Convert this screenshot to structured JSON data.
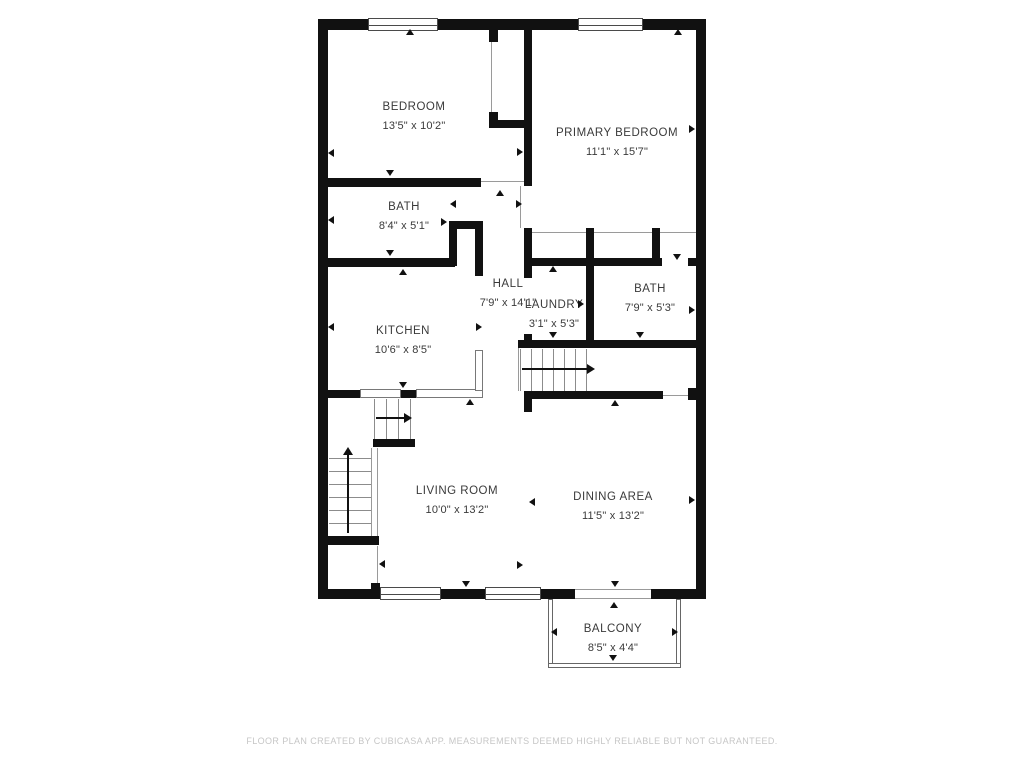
{
  "floorplan": {
    "colors": {
      "wall": "#111111",
      "label": "#3a3a3a",
      "thin_line": "#9a9a9a",
      "footer": "#c6c6c6",
      "background": "#ffffff"
    },
    "rooms": [
      {
        "id": "bedroom",
        "name": "BEDROOM",
        "dims": "13'5\" x 10'2\"",
        "cx": 414,
        "cy": 107
      },
      {
        "id": "primary-bedroom",
        "name": "PRIMARY BEDROOM",
        "dims": "11'1\" x 15'7\"",
        "cx": 617,
        "cy": 133
      },
      {
        "id": "bath",
        "name": "BATH",
        "dims": "8'4\" x 5'1\"",
        "cx": 404,
        "cy": 207
      },
      {
        "id": "hall",
        "name": "HALL",
        "dims": "7'9\" x 14'1\"",
        "cx": 508,
        "cy": 284
      },
      {
        "id": "laundry",
        "name": "LAUNDRY",
        "dims": "3'1\" x 5'3\"",
        "cx": 554,
        "cy": 305
      },
      {
        "id": "bath-2",
        "name": "BATH",
        "dims": "7'9\" x 5'3\"",
        "cx": 650,
        "cy": 289
      },
      {
        "id": "kitchen",
        "name": "KITCHEN",
        "dims": "10'6\" x 8'5\"",
        "cx": 403,
        "cy": 331
      },
      {
        "id": "living-room",
        "name": "LIVING ROOM",
        "dims": "10'0\" x 13'2\"",
        "cx": 457,
        "cy": 491
      },
      {
        "id": "dining-area",
        "name": "DINING AREA",
        "dims": "11'5\" x 13'2\"",
        "cx": 613,
        "cy": 497
      },
      {
        "id": "balcony",
        "name": "BALCONY",
        "dims": "8'5\" x 4'4\"",
        "cx": 613,
        "cy": 629
      }
    ],
    "walls": [
      [
        318,
        19,
        388,
        11
      ],
      [
        318,
        19,
        10,
        580
      ],
      [
        696,
        19,
        10,
        580
      ],
      [
        318,
        589,
        62,
        10
      ],
      [
        441,
        589,
        44,
        10
      ],
      [
        541,
        589,
        34,
        10
      ],
      [
        651,
        589,
        55,
        10
      ],
      [
        318,
        178,
        163,
        9
      ],
      [
        524,
        28,
        8,
        158
      ],
      [
        489,
        28,
        9,
        14
      ],
      [
        489,
        112,
        9,
        16
      ],
      [
        489,
        120,
        43,
        8
      ],
      [
        318,
        258,
        137,
        9
      ],
      [
        449,
        221,
        8,
        45
      ],
      [
        449,
        221,
        34,
        8
      ],
      [
        475,
        221,
        8,
        55
      ],
      [
        524,
        228,
        8,
        38
      ],
      [
        586,
        228,
        8,
        118
      ],
      [
        652,
        228,
        8,
        38
      ],
      [
        524,
        258,
        138,
        8
      ],
      [
        688,
        258,
        8,
        8
      ],
      [
        524,
        266,
        8,
        12
      ],
      [
        524,
        334,
        8,
        12
      ],
      [
        518,
        340,
        188,
        8
      ],
      [
        528,
        391,
        135,
        8
      ],
      [
        524,
        391,
        8,
        21
      ],
      [
        688,
        388,
        8,
        12
      ],
      [
        318,
        390,
        42,
        8
      ],
      [
        401,
        390,
        15,
        8
      ],
      [
        373,
        439,
        42,
        8
      ],
      [
        326,
        536,
        53,
        9
      ],
      [
        371,
        583,
        9,
        7
      ]
    ],
    "thin_lines": [
      [
        491,
        42,
        1,
        71
      ],
      [
        520,
        186,
        1,
        42
      ],
      [
        532,
        232,
        54,
        1
      ],
      [
        594,
        232,
        58,
        1
      ],
      [
        660,
        232,
        36,
        1
      ],
      [
        481,
        181,
        43,
        1
      ],
      [
        663,
        395,
        25,
        1
      ],
      [
        518,
        348,
        1,
        43
      ],
      [
        371,
        448,
        1,
        89
      ],
      [
        377,
        448,
        1,
        89
      ],
      [
        377,
        546,
        1,
        43
      ]
    ],
    "stair_treads": [
      [
        520,
        349,
        1,
        42
      ],
      [
        531,
        349,
        1,
        42
      ],
      [
        542,
        349,
        1,
        42
      ],
      [
        553,
        349,
        1,
        42
      ],
      [
        564,
        349,
        1,
        42
      ],
      [
        575,
        349,
        1,
        42
      ],
      [
        586,
        349,
        1,
        42
      ],
      [
        374,
        399,
        1,
        40
      ],
      [
        386,
        399,
        1,
        40
      ],
      [
        398,
        399,
        1,
        40
      ],
      [
        410,
        399,
        1,
        40
      ],
      [
        329,
        458,
        42,
        1
      ],
      [
        329,
        471,
        42,
        1
      ],
      [
        329,
        484,
        42,
        1
      ],
      [
        329,
        497,
        42,
        1
      ],
      [
        329,
        510,
        42,
        1
      ],
      [
        329,
        523,
        42,
        1
      ]
    ],
    "windows": [
      [
        368,
        18,
        70,
        13
      ],
      [
        578,
        18,
        65,
        13
      ],
      [
        380,
        587,
        61,
        13
      ],
      [
        485,
        587,
        56,
        13
      ]
    ],
    "counters": [
      [
        360,
        389,
        41,
        9
      ],
      [
        416,
        389,
        67,
        9
      ],
      [
        475,
        350,
        8,
        41
      ]
    ],
    "openings": [
      [
        575,
        589,
        76,
        10
      ]
    ],
    "railings": [
      [
        548,
        599,
        5,
        66
      ],
      [
        676,
        599,
        5,
        66
      ],
      [
        548,
        663,
        133,
        5
      ]
    ],
    "markers": [
      [
        328,
        153,
        "left"
      ],
      [
        410,
        29,
        "up"
      ],
      [
        390,
        176,
        "down"
      ],
      [
        500,
        190,
        "up"
      ],
      [
        523,
        152,
        "right"
      ],
      [
        695,
        129,
        "right"
      ],
      [
        678,
        29,
        "up"
      ],
      [
        328,
        220,
        "left"
      ],
      [
        447,
        222,
        "right"
      ],
      [
        390,
        256,
        "down"
      ],
      [
        403,
        269,
        "up"
      ],
      [
        328,
        327,
        "left"
      ],
      [
        482,
        327,
        "right"
      ],
      [
        450,
        204,
        "left"
      ],
      [
        522,
        204,
        "right"
      ],
      [
        553,
        266,
        "up"
      ],
      [
        553,
        338,
        "down"
      ],
      [
        584,
        304,
        "right"
      ],
      [
        677,
        260,
        "down"
      ],
      [
        695,
        310,
        "right"
      ],
      [
        640,
        338,
        "down"
      ],
      [
        615,
        400,
        "up"
      ],
      [
        403,
        388,
        "down"
      ],
      [
        470,
        399,
        "up"
      ],
      [
        379,
        564,
        "left"
      ],
      [
        523,
        565,
        "right"
      ],
      [
        529,
        502,
        "left"
      ],
      [
        695,
        500,
        "right"
      ],
      [
        615,
        587,
        "down"
      ],
      [
        614,
        602,
        "up"
      ],
      [
        551,
        632,
        "left"
      ],
      [
        678,
        632,
        "right"
      ],
      [
        613,
        661,
        "down"
      ],
      [
        466,
        587,
        "down"
      ]
    ],
    "arrows": [
      {
        "x": 522,
        "y": 369,
        "len": 65,
        "dir": "right"
      },
      {
        "x": 376,
        "y": 418,
        "len": 28,
        "dir": "right"
      },
      {
        "x": 348,
        "y": 455,
        "len": 78,
        "dir": "up"
      }
    ],
    "footer": {
      "text": "FLOOR PLAN CREATED BY CUBICASA APP. MEASUREMENTS DEEMED HIGHLY RELIABLE BUT NOT GUARANTEED."
    }
  }
}
